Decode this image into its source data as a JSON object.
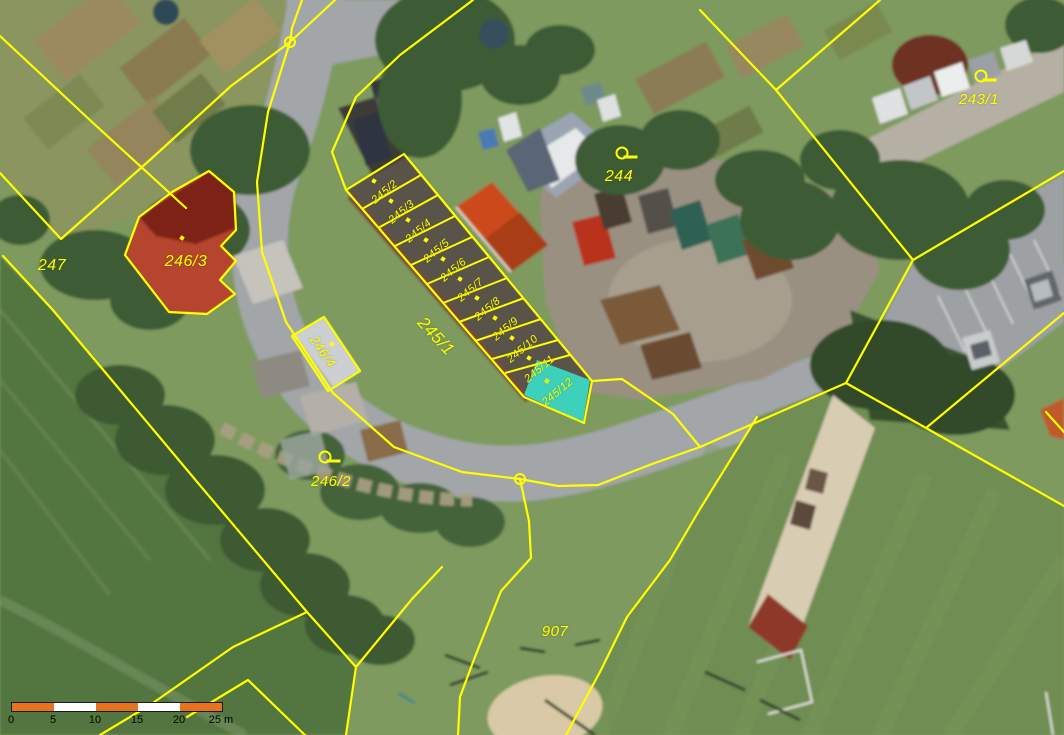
{
  "app": {
    "type": "cadastral-orthophoto-map"
  },
  "map": {
    "highlighted_parcel_id": "245/12",
    "colors": {
      "boundary": "#ffff00",
      "label": "#ffff00",
      "highlight_fill": "#3bdcc6",
      "scalebar_orange": "#e8731e",
      "scalebar_white": "#ffffff",
      "scalebar_text": "#000000"
    },
    "parcel_labels": [
      {
        "id": "247",
        "text": "247",
        "x": 52,
        "y": 267,
        "rot": 0,
        "size": 16
      },
      {
        "id": "246/3",
        "text": "246/3",
        "x": 186,
        "y": 263,
        "rot": 0,
        "size": 16,
        "dot": [
          -4,
          -25
        ]
      },
      {
        "id": "246/4",
        "text": "246/4",
        "x": 323,
        "y": 352,
        "rot": 55,
        "size": 13,
        "dot": [
          9,
          -8
        ]
      },
      {
        "id": "246/2",
        "text": "246/2",
        "x": 331,
        "y": 482,
        "rot": 0,
        "size": 15
      },
      {
        "id": "245/1",
        "text": "245/1",
        "x": 436,
        "y": 337,
        "rot": 47,
        "size": 17
      },
      {
        "id": "245/2",
        "text": "245/2",
        "x": 385,
        "y": 193,
        "rot": -40,
        "size": 11,
        "dot": [
          -11,
          -12
        ]
      },
      {
        "id": "245/3",
        "text": "245/3",
        "x": 402,
        "y": 213,
        "rot": -40,
        "size": 11,
        "dot": [
          -11,
          -12
        ]
      },
      {
        "id": "245/4",
        "text": "245/4",
        "x": 419,
        "y": 232,
        "rot": -40,
        "size": 11,
        "dot": [
          -11,
          -12
        ]
      },
      {
        "id": "245/5",
        "text": "245/5",
        "x": 437,
        "y": 252,
        "rot": -40,
        "size": 11,
        "dot": [
          -11,
          -12
        ]
      },
      {
        "id": "245/6",
        "text": "245/6",
        "x": 454,
        "y": 271,
        "rot": -40,
        "size": 11,
        "dot": [
          -11,
          -12
        ]
      },
      {
        "id": "245/7",
        "text": "245/7",
        "x": 471,
        "y": 291,
        "rot": -40,
        "size": 11,
        "dot": [
          -11,
          -12
        ]
      },
      {
        "id": "245/8",
        "text": "245/8",
        "x": 488,
        "y": 310,
        "rot": -40,
        "size": 11,
        "dot": [
          -11,
          -12
        ]
      },
      {
        "id": "245/9",
        "text": "245/9",
        "x": 506,
        "y": 330,
        "rot": -40,
        "size": 11,
        "dot": [
          -11,
          -12
        ]
      },
      {
        "id": "245/10",
        "text": "245/10",
        "x": 523,
        "y": 350,
        "rot": -40,
        "size": 11,
        "dot": [
          -11,
          -12
        ]
      },
      {
        "id": "245/11",
        "text": "245/11",
        "x": 540,
        "y": 370,
        "rot": -40,
        "size": 11,
        "dot": [
          -11,
          -12
        ]
      },
      {
        "id": "245/12",
        "text": "245/12",
        "x": 558,
        "y": 393,
        "rot": -40,
        "size": 11,
        "dot": [
          -11,
          -12
        ]
      },
      {
        "id": "244",
        "text": "244",
        "x": 619,
        "y": 178,
        "rot": 0,
        "size": 16
      },
      {
        "id": "243/1",
        "text": "243/1",
        "x": 979,
        "y": 100,
        "rot": 0,
        "size": 15
      },
      {
        "id": "907",
        "text": "907",
        "x": 555,
        "y": 632,
        "rot": 0,
        "size": 15
      }
    ],
    "reference_symbols": [
      {
        "parcel": "244",
        "x": 622,
        "y": 153
      },
      {
        "parcel": "243/1",
        "x": 981,
        "y": 76
      },
      {
        "parcel": "246/2",
        "x": 325,
        "y": 457
      }
    ],
    "boundary_points": [
      {
        "x": 290,
        "y": 42
      },
      {
        "x": 520,
        "y": 479
      }
    ],
    "scale_bar": {
      "x": 11,
      "y": 702,
      "height": 8,
      "segment_width": 42,
      "segment_colors": [
        "#e8731e",
        "#ffffff",
        "#e8731e",
        "#ffffff",
        "#e8731e"
      ],
      "tick_labels": [
        "0",
        "5",
        "10",
        "15",
        "20",
        "25 m"
      ],
      "unit": "m",
      "length_m": 25
    }
  }
}
